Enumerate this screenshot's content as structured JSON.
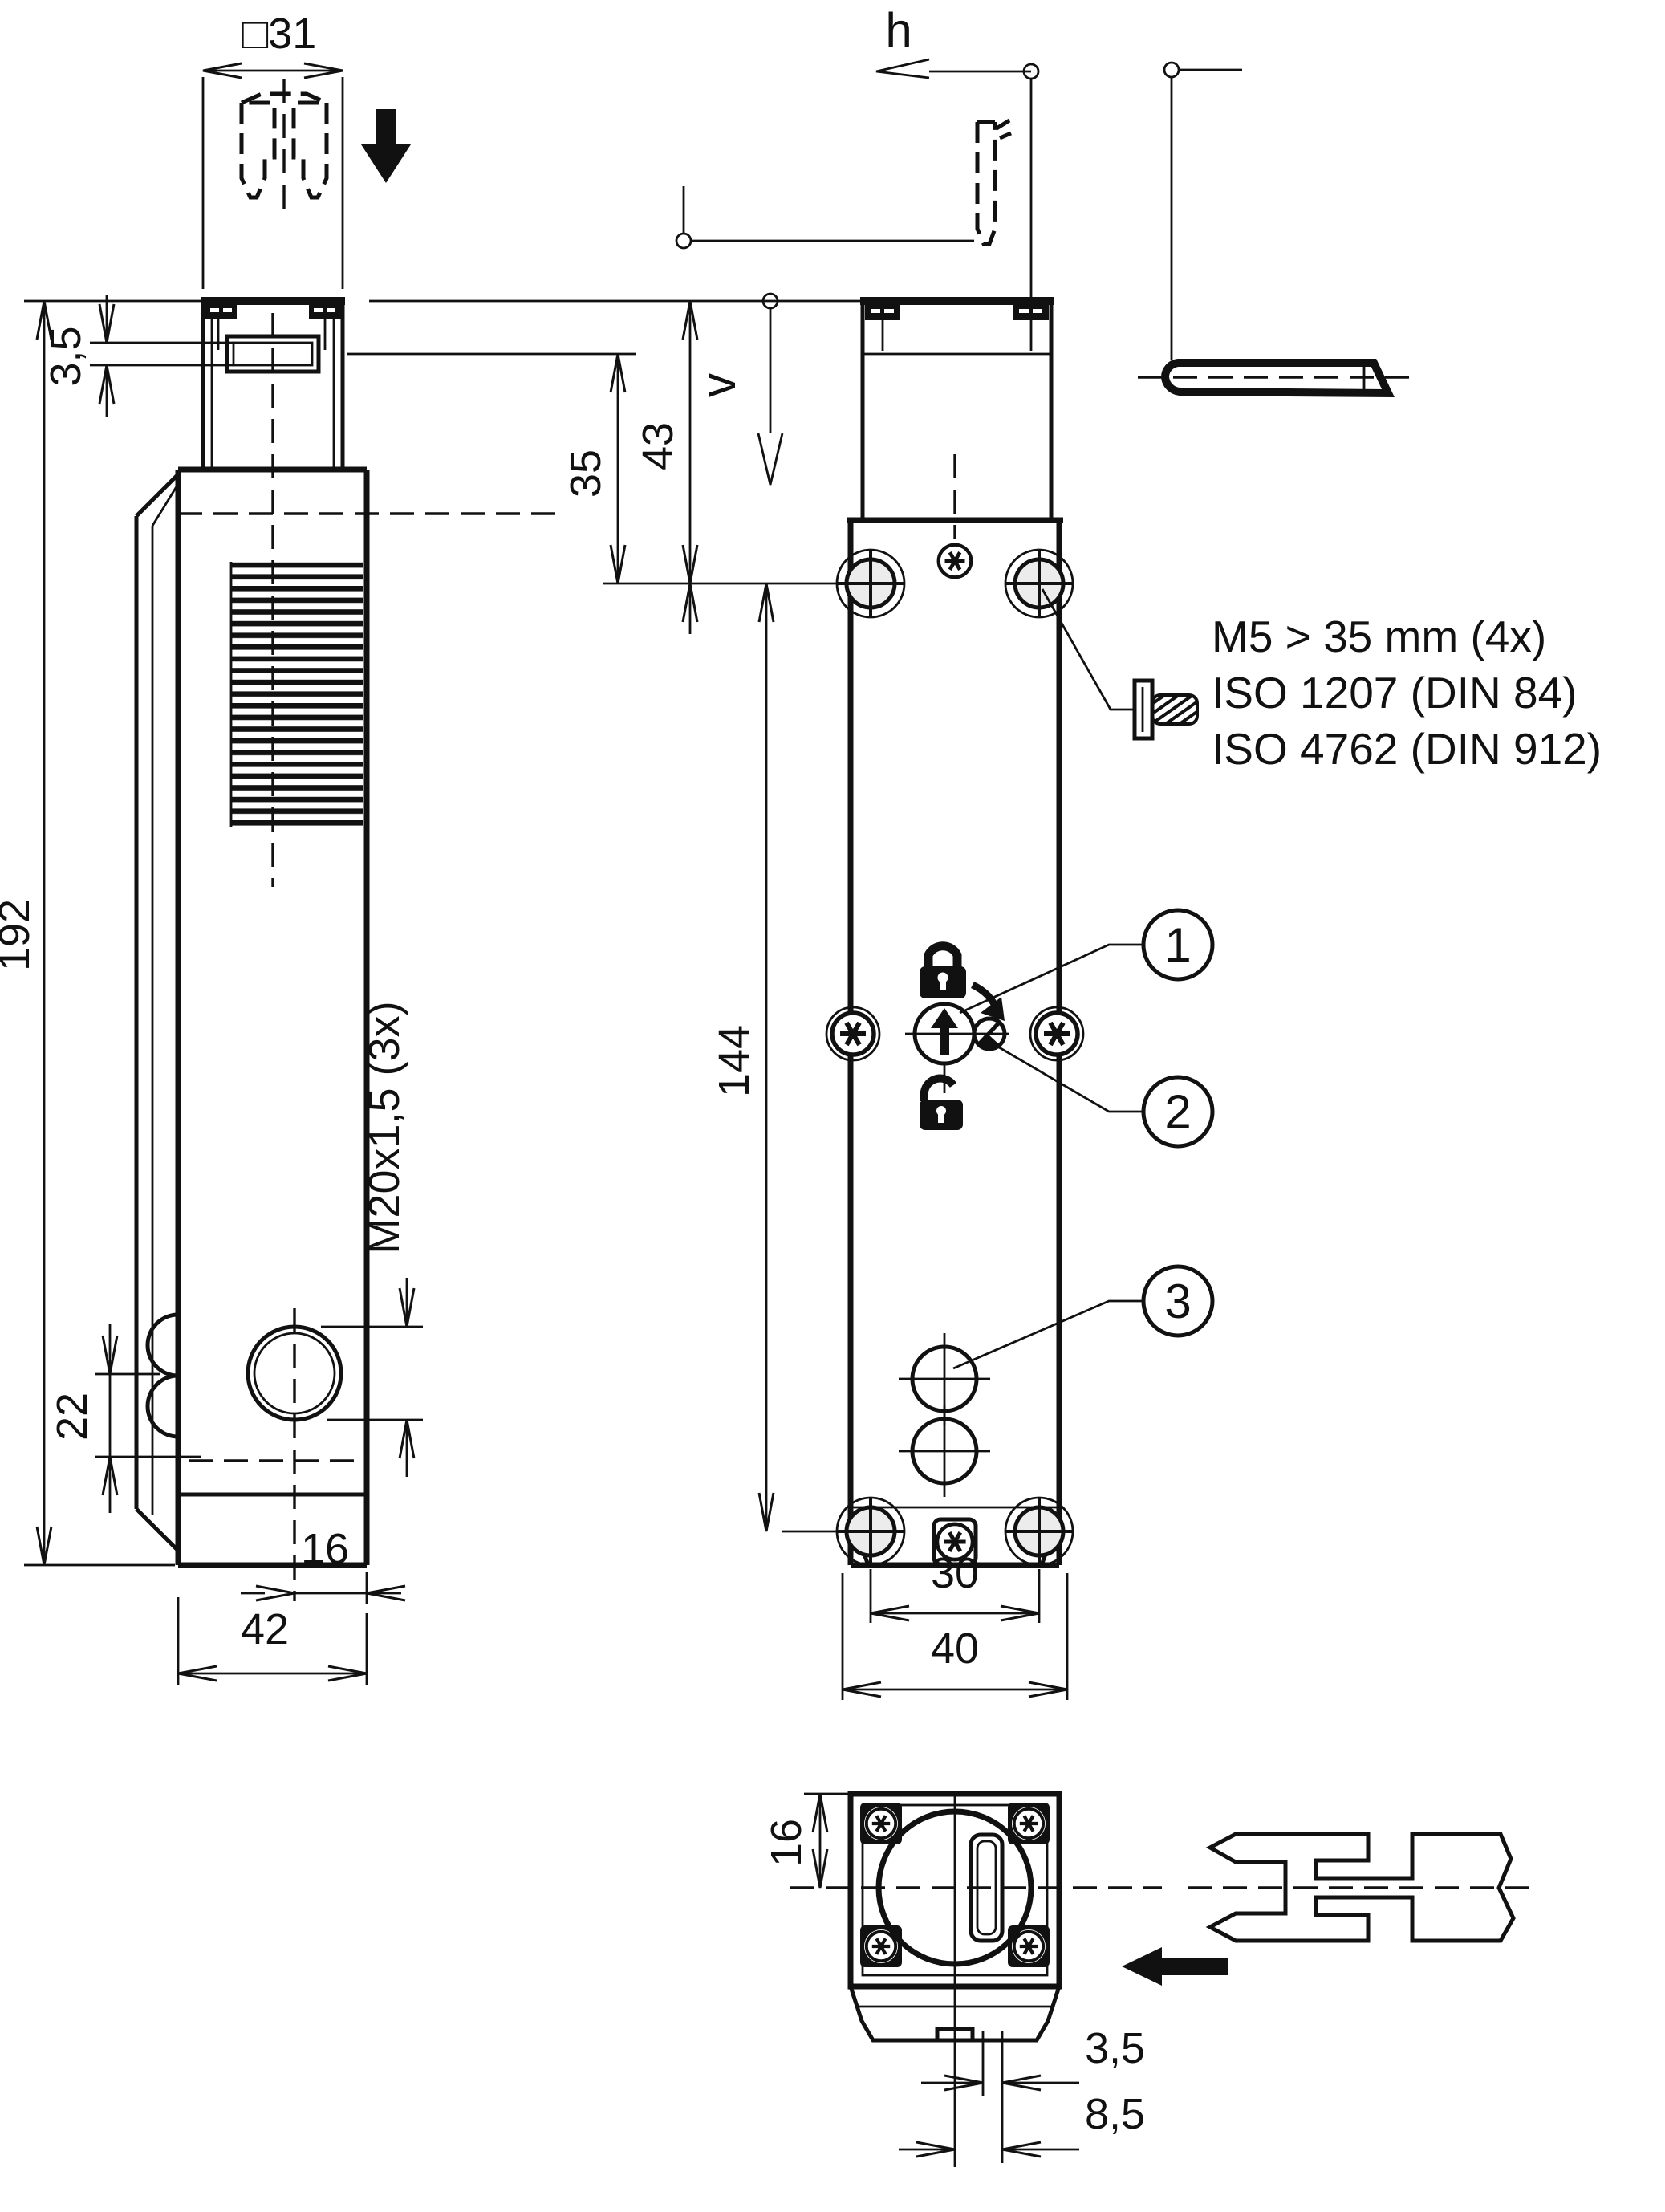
{
  "labels": {
    "head_width": "□31",
    "slot_height": "3,5",
    "total_height": "192",
    "gland_height": "22",
    "gland_offset": "16",
    "depth": "42",
    "slot_to_holes": "35",
    "top_to_holes": "43",
    "hole_spacing": "144",
    "gland_thread": "M20x1,5 (3x)",
    "hole_width": "30",
    "width": "40",
    "approach_h": "h",
    "approach_v": "v",
    "bottom_front": "16",
    "slot_wall": "3,5",
    "slot_offset": "8,5"
  },
  "notes": {
    "screws": "M5 > 35 mm (4x)",
    "iso1": "ISO 1207 (DIN 84)",
    "iso2": "ISO 4762 (DIN 912)"
  },
  "callouts": {
    "c1": "1",
    "c2": "2",
    "c3": "3"
  }
}
